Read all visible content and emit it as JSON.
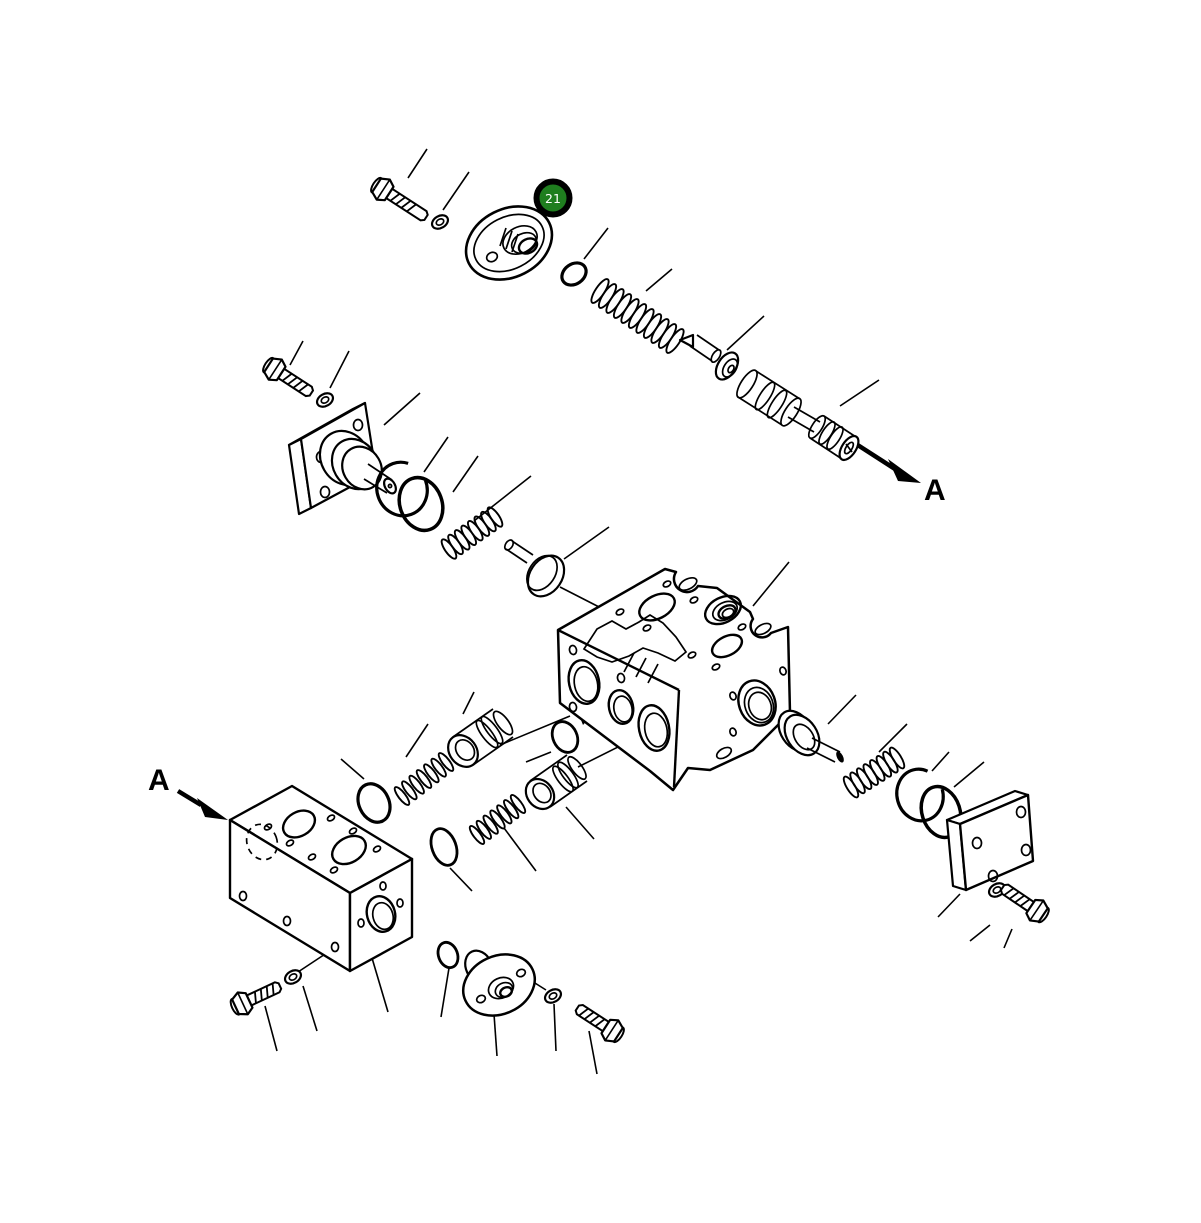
{
  "diagram": {
    "background_color": "#ffffff",
    "line_color": "#000000",
    "callout_badge": {
      "text": "21",
      "fill_color": "#1f7e1f",
      "ring_color": "#000000",
      "text_color": "#ffffff"
    },
    "section_labels": {
      "upper_right": "A",
      "lower_left": "A"
    },
    "parts": [
      "hex-bolt",
      "flat-washer",
      "check-valve-cover",
      "o-ring",
      "coil-spring",
      "check-valve-poppet",
      "control-spool",
      "hex-bolt",
      "flat-washer",
      "spring-seat-plate",
      "snap-ring",
      "o-ring",
      "coil-spring",
      "plunger",
      "main-valve-body",
      "o-ring",
      "coil-spring",
      "check-valve-plug",
      "o-ring",
      "check-valve-plug",
      "coil-spring",
      "o-ring",
      "end-manifold-block",
      "hex-bolt",
      "flat-washer",
      "o-ring",
      "oval-plug-cover",
      "flat-washer",
      "hex-bolt",
      "flanged-pilot-pin",
      "coil-spring",
      "snap-ring",
      "o-ring",
      "end-cover-plate",
      "flat-washer",
      "hex-bolt"
    ]
  }
}
